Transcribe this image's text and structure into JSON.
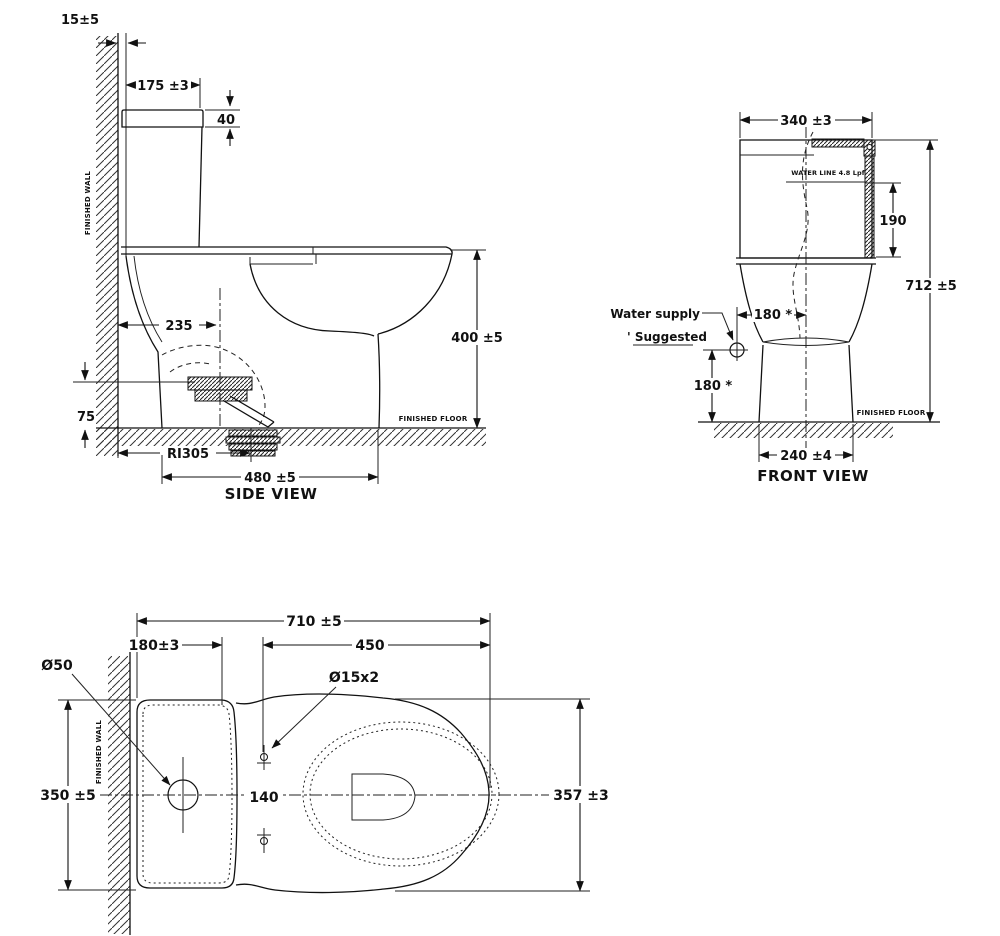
{
  "side_view": {
    "title": "SIDE VIEW",
    "dim_wall_gap": "15±5",
    "dim_tank_top_width": "175 ±3",
    "dim_lid_height": "40",
    "dim_outlet_from_wall": "235",
    "dim_outlet_height": "75",
    "dim_rough_in": "RI305",
    "dim_depth": "480 ±5",
    "dim_seat_height": "400 ±5",
    "finished_wall": "FINISHED WALL",
    "finished_floor": "FINISHED FLOOR"
  },
  "front_view": {
    "title": "FRONT VIEW",
    "dim_tank_width": "340 ±3",
    "water_line_note": "WATER LINE 4.8 Lpf",
    "dim_water_depth": "190",
    "dim_total_height": "712 ±5",
    "water_supply_label": "Water supply",
    "suggested_note": "' Suggested",
    "dim_supply_offset": "180 *",
    "dim_supply_height": "180 *",
    "dim_base_width": "240 ±4",
    "finished_floor": "FINISHED FLOOR"
  },
  "plan_view": {
    "dim_total_length": "710 ±5",
    "dim_tank_depth": "180±3",
    "dim_bowl_length": "450",
    "supply_hole_label": "Ø50",
    "bolt_holes_label": "Ø15x2",
    "dim_overall_width": "350 ±5",
    "dim_bolt_spacing": "140",
    "dim_bowl_width": "357 ±3",
    "finished_wall": "FINISHED WALL"
  }
}
